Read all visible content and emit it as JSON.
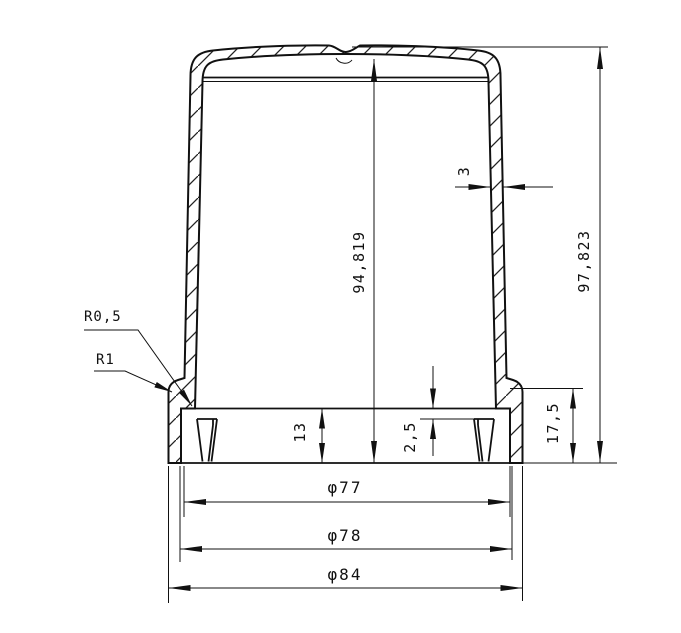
{
  "drawing": {
    "background": "#ffffff",
    "line_color": "#111111",
    "labels": {
      "radius_fillet_small": "R0,5",
      "radius_fillet_large": "R1",
      "wall_thickness": "3",
      "height_inner": "94,819",
      "height_overall": "97,823",
      "skirt_depth": "13",
      "rib_offset": "2,5",
      "base_height": "17,5",
      "diameter_inner": "φ77",
      "diameter_middle": "φ78",
      "diameter_outer": "φ84"
    }
  }
}
